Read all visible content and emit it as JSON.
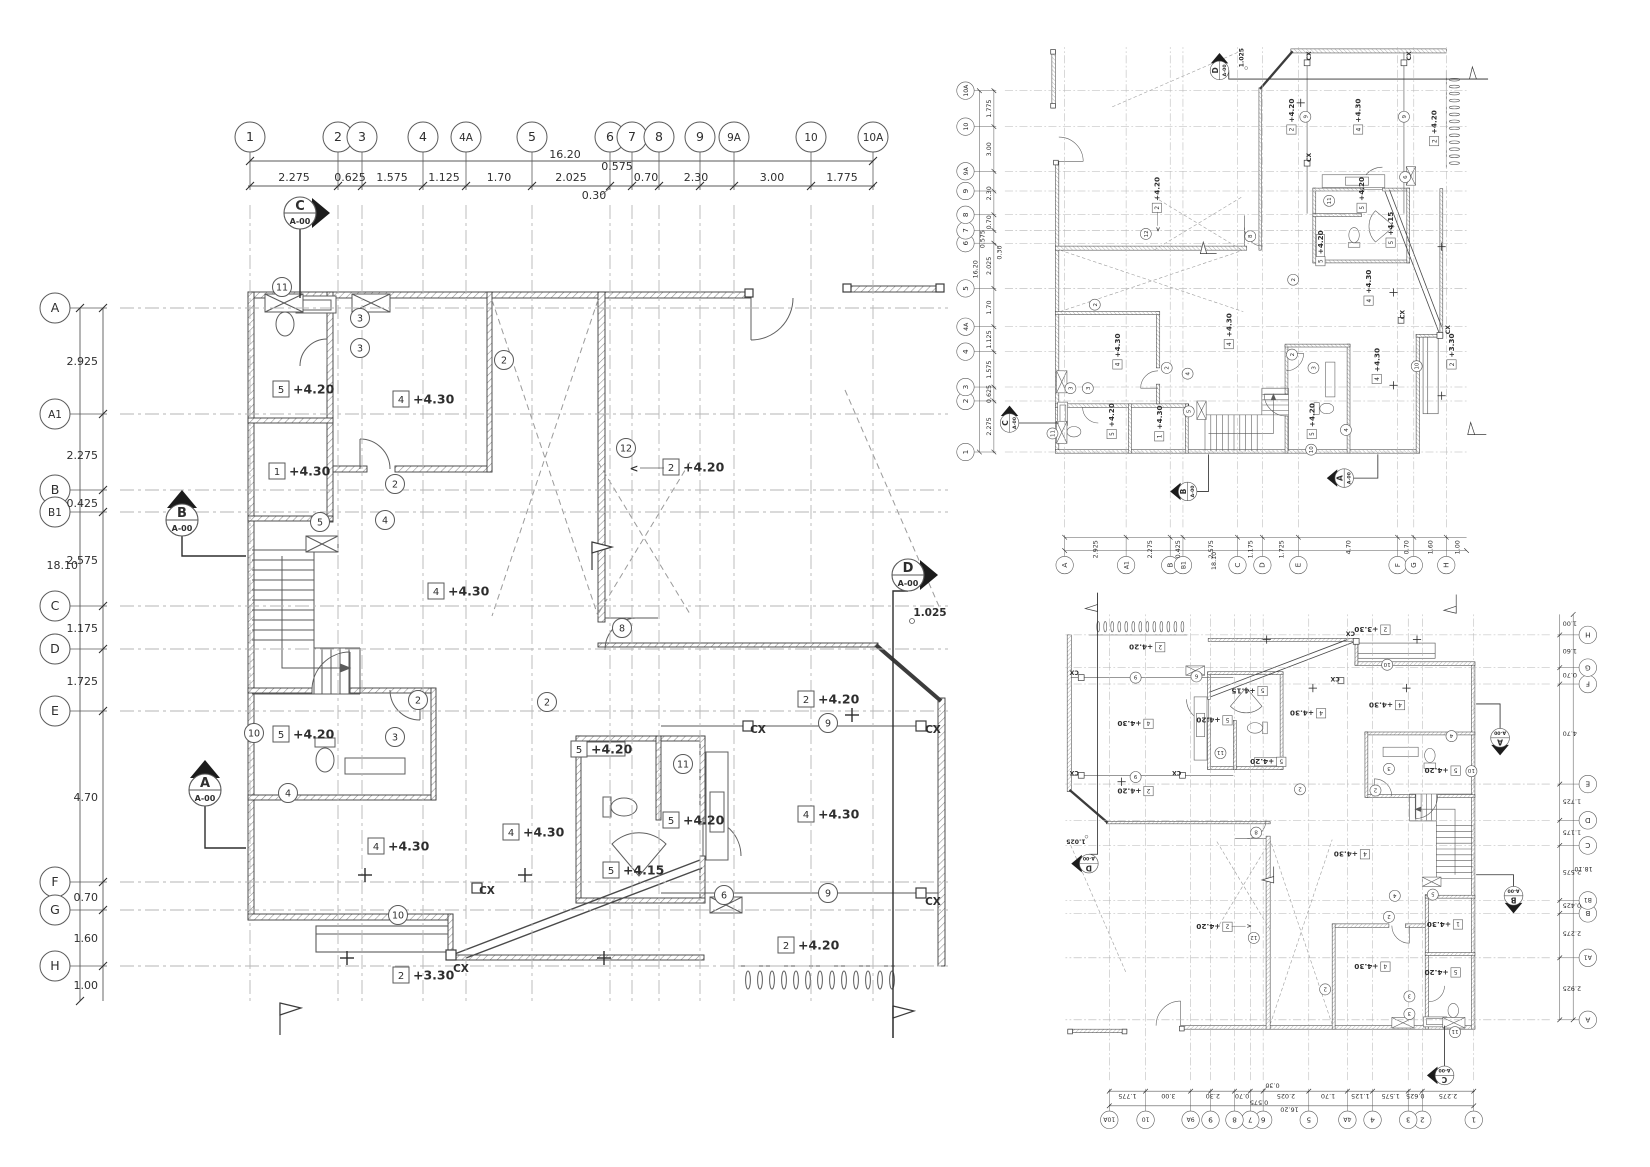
{
  "sheet": {
    "width": 1650,
    "height": 1167,
    "background": "#ffffff"
  },
  "colors": {
    "ink": "#2e2e2e",
    "wall": "#3c3c3c",
    "thin": "#5a5a5a",
    "grid": "#b6b6b6",
    "dash": "#9a9a9a"
  },
  "plan": {
    "grid_cols": [
      {
        "id": "1",
        "x": 250
      },
      {
        "id": "2",
        "x": 338
      },
      {
        "id": "3",
        "x": 362
      },
      {
        "id": "4",
        "x": 423
      },
      {
        "id": "4A",
        "x": 466
      },
      {
        "id": "5",
        "x": 532
      },
      {
        "id": "6",
        "x": 610
      },
      {
        "id": "7",
        "x": 632
      },
      {
        "id": "8",
        "x": 659
      },
      {
        "id": "9",
        "x": 700
      },
      {
        "id": "9A",
        "x": 734
      },
      {
        "id": "10",
        "x": 811
      },
      {
        "id": "10A",
        "x": 873
      }
    ],
    "grid_rows": [
      {
        "id": "A",
        "y": 308
      },
      {
        "id": "A1",
        "y": 414
      },
      {
        "id": "B",
        "y": 490
      },
      {
        "id": "B1",
        "y": 512
      },
      {
        "id": "C",
        "y": 606
      },
      {
        "id": "D",
        "y": 649
      },
      {
        "id": "E",
        "y": 711
      },
      {
        "id": "F",
        "y": 882
      },
      {
        "id": "G",
        "y": 910
      },
      {
        "id": "H",
        "y": 966
      }
    ],
    "col_dims": [
      {
        "v": "2.275",
        "x": 294
      },
      {
        "v": "0.625",
        "x": 350
      },
      {
        "v": "1.575",
        "x": 392
      },
      {
        "v": "1.125",
        "x": 444
      },
      {
        "v": "1.70",
        "x": 499
      },
      {
        "v": "2.025",
        "x": 571
      },
      {
        "v": "0.70",
        "x": 646
      },
      {
        "v": "2.30",
        "x": 696
      },
      {
        "v": "3.00",
        "x": 772
      },
      {
        "v": "1.775",
        "x": 842
      }
    ],
    "col_total": {
      "v": "16.20",
      "x": 565,
      "y": 158
    },
    "col_extra": [
      {
        "v": "0.575",
        "x": 617,
        "y": 170
      },
      {
        "v": "0.30",
        "x": 594,
        "y": 199
      }
    ],
    "row_dims": [
      {
        "v": "2.925",
        "y": 361
      },
      {
        "v": "2.275",
        "y": 455
      },
      {
        "v": "0.425",
        "y": 503
      },
      {
        "v": "2.575",
        "y": 560
      },
      {
        "v": "1.175",
        "y": 628
      },
      {
        "v": "1.725",
        "y": 681
      },
      {
        "v": "4.70",
        "y": 797
      },
      {
        "v": "0.70",
        "y": 897
      },
      {
        "v": "1.60",
        "y": 938
      },
      {
        "v": "1.00",
        "y": 985
      }
    ],
    "row_total": {
      "v": "18.10",
      "x": 78,
      "y": 569
    },
    "levels": [
      {
        "tag": "5",
        "lvl": "+4.20",
        "x": 281,
        "y": 390
      },
      {
        "tag": "4",
        "lvl": "+4.30",
        "x": 401,
        "y": 400
      },
      {
        "tag": "1",
        "lvl": "+4.30",
        "x": 277,
        "y": 472
      },
      {
        "tag": "2",
        "lvl": "+4.20",
        "x": 671,
        "y": 468
      },
      {
        "tag": "4",
        "lvl": "+4.30",
        "x": 436,
        "y": 592
      },
      {
        "tag": "5",
        "lvl": "+4.20",
        "x": 281,
        "y": 735
      },
      {
        "tag": "4",
        "lvl": "+4.30",
        "x": 376,
        "y": 847
      },
      {
        "tag": "2",
        "lvl": "+4.20",
        "x": 806,
        "y": 700
      },
      {
        "tag": "4",
        "lvl": "+4.30",
        "x": 806,
        "y": 815
      },
      {
        "tag": "5",
        "lvl": "+4.20",
        "x": 579,
        "y": 750
      },
      {
        "tag": "5",
        "lvl": "+4.20",
        "x": 671,
        "y": 821
      },
      {
        "tag": "4",
        "lvl": "+4.30",
        "x": 511,
        "y": 833
      },
      {
        "tag": "5",
        "lvl": "+4.15",
        "x": 611,
        "y": 871
      },
      {
        "tag": "2",
        "lvl": "+3.30",
        "x": 401,
        "y": 976
      },
      {
        "tag": "2",
        "lvl": "+4.20",
        "x": 786,
        "y": 946
      }
    ],
    "marks": [
      {
        "t": "11",
        "x": 282,
        "y": 287
      },
      {
        "t": "3",
        "x": 360,
        "y": 318
      },
      {
        "t": "3",
        "x": 360,
        "y": 348
      },
      {
        "t": "2",
        "x": 504,
        "y": 360
      },
      {
        "t": "2",
        "x": 395,
        "y": 484
      },
      {
        "t": "4",
        "x": 385,
        "y": 520
      },
      {
        "t": "5",
        "x": 320,
        "y": 522
      },
      {
        "t": "12",
        "x": 626,
        "y": 448
      },
      {
        "t": "8",
        "x": 622,
        "y": 628
      },
      {
        "t": "10",
        "x": 254,
        "y": 733
      },
      {
        "t": "2",
        "x": 418,
        "y": 700
      },
      {
        "t": "3",
        "x": 395,
        "y": 737
      },
      {
        "t": "4",
        "x": 288,
        "y": 793
      },
      {
        "t": "2",
        "x": 547,
        "y": 702
      },
      {
        "t": "11",
        "x": 683,
        "y": 764
      },
      {
        "t": "6",
        "x": 724,
        "y": 895
      },
      {
        "t": "9",
        "x": 828,
        "y": 723
      },
      {
        "t": "9",
        "x": 828,
        "y": 893
      },
      {
        "t": "10",
        "x": 398,
        "y": 915
      }
    ],
    "texts": [
      {
        "t": "CX",
        "x": 758,
        "y": 733
      },
      {
        "t": "CX",
        "x": 933,
        "y": 733
      },
      {
        "t": "CX",
        "x": 487,
        "y": 894
      },
      {
        "t": "CX",
        "x": 933,
        "y": 905
      },
      {
        "t": "CX",
        "x": 461,
        "y": 972
      },
      {
        "t": "1.025",
        "x": 930,
        "y": 616
      },
      {
        "t": "<",
        "x": 634,
        "y": 472
      }
    ],
    "sections": [
      {
        "id": "C",
        "ref": "A-00",
        "x": 300,
        "y": 213,
        "dir": "right"
      },
      {
        "id": "B",
        "ref": "A-00",
        "x": 182,
        "y": 520,
        "dir": "up"
      },
      {
        "id": "A",
        "ref": "A-00",
        "x": 205,
        "y": 790,
        "dir": "up"
      },
      {
        "id": "D",
        "ref": "A-00",
        "x": 908,
        "y": 575,
        "dir": "right"
      }
    ],
    "pluses": [
      [
        365,
        875
      ],
      [
        525,
        875
      ],
      [
        347,
        958
      ],
      [
        604,
        958
      ],
      [
        852,
        715
      ]
    ]
  },
  "views": [
    {
      "name": "plan-main"
    },
    {
      "name": "plan-rotated-90"
    },
    {
      "name": "plan-rotated-180"
    }
  ]
}
